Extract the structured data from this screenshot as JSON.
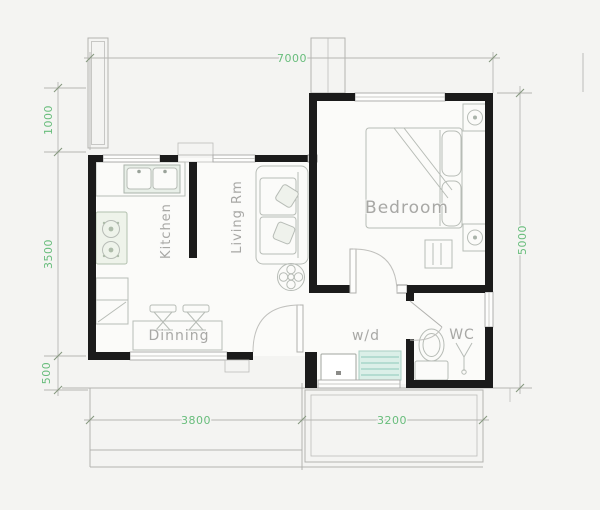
{
  "floorplan": {
    "title": "one-bedroom house floor plan",
    "rooms": {
      "kitchen": "Kitchen",
      "living": "Living Rm",
      "bedroom": "Bedroom",
      "dinning": "Dinning",
      "wd": "w/d",
      "wc": "WC"
    },
    "dimensions": {
      "top": "7000",
      "left_upper": "1000",
      "left_mid": "3500",
      "left_lower": "500",
      "right": "5000",
      "bottom_left": "3800",
      "bottom_right": "3200"
    },
    "colors": {
      "dimension_text": "#68bd7c",
      "room_text": "#a8a8a5",
      "wall": "#1b1b1b",
      "line": "#b3b3b0",
      "fixture_teal": "#dbefe8",
      "floor": "#fbfbf9",
      "background": "#f4f4f2"
    },
    "fixtures": [
      "kitchen-sink",
      "gas-stove",
      "dining-table",
      "stool",
      "sofa",
      "ceiling-fan",
      "double-bed",
      "nightstand-lamp",
      "washing-machine",
      "dryer-shelf",
      "toilet",
      "wash-basin"
    ]
  }
}
